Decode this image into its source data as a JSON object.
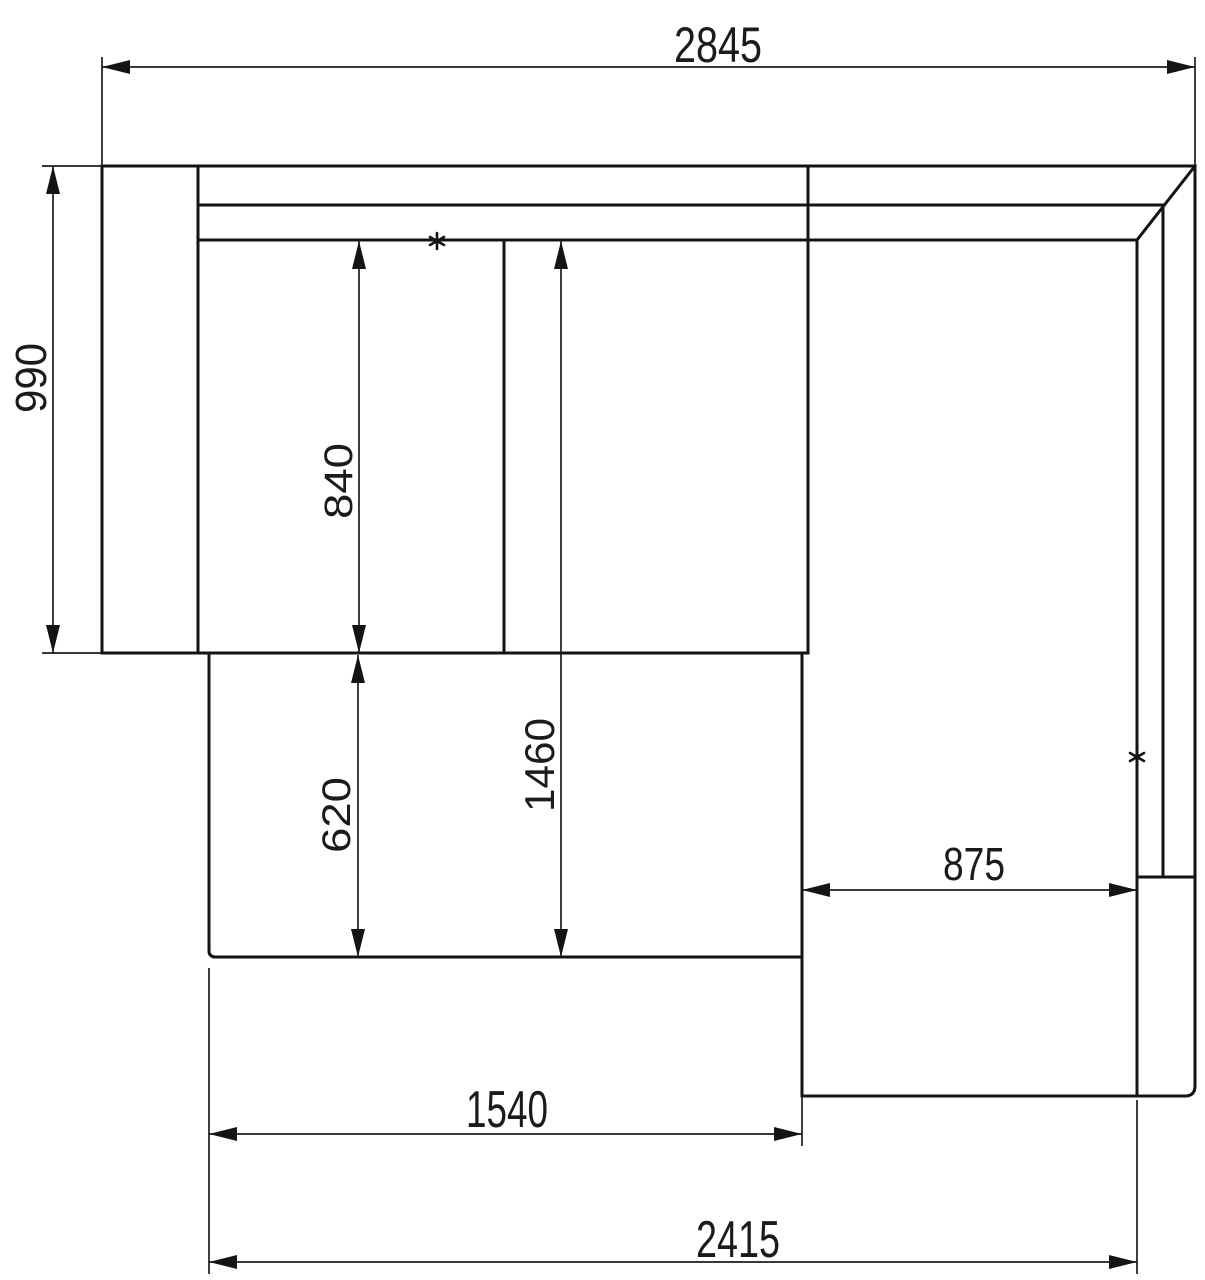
{
  "drawing": {
    "background_color": "#ffffff",
    "line_color": "#141414"
  },
  "dimensions": {
    "overall_width": {
      "label": "2845"
    },
    "overall_depth": {
      "label": "990"
    },
    "seat_depth": {
      "label": "840"
    },
    "sleeping_length": {
      "label": "1460"
    },
    "extension_depth": {
      "label": "620"
    },
    "chaise_width": {
      "label": "875"
    },
    "front_width": {
      "label": "1540"
    },
    "lower_overall_width": {
      "label": "2415"
    }
  },
  "icons": {
    "marker_symbol": "asterisk-marker"
  }
}
